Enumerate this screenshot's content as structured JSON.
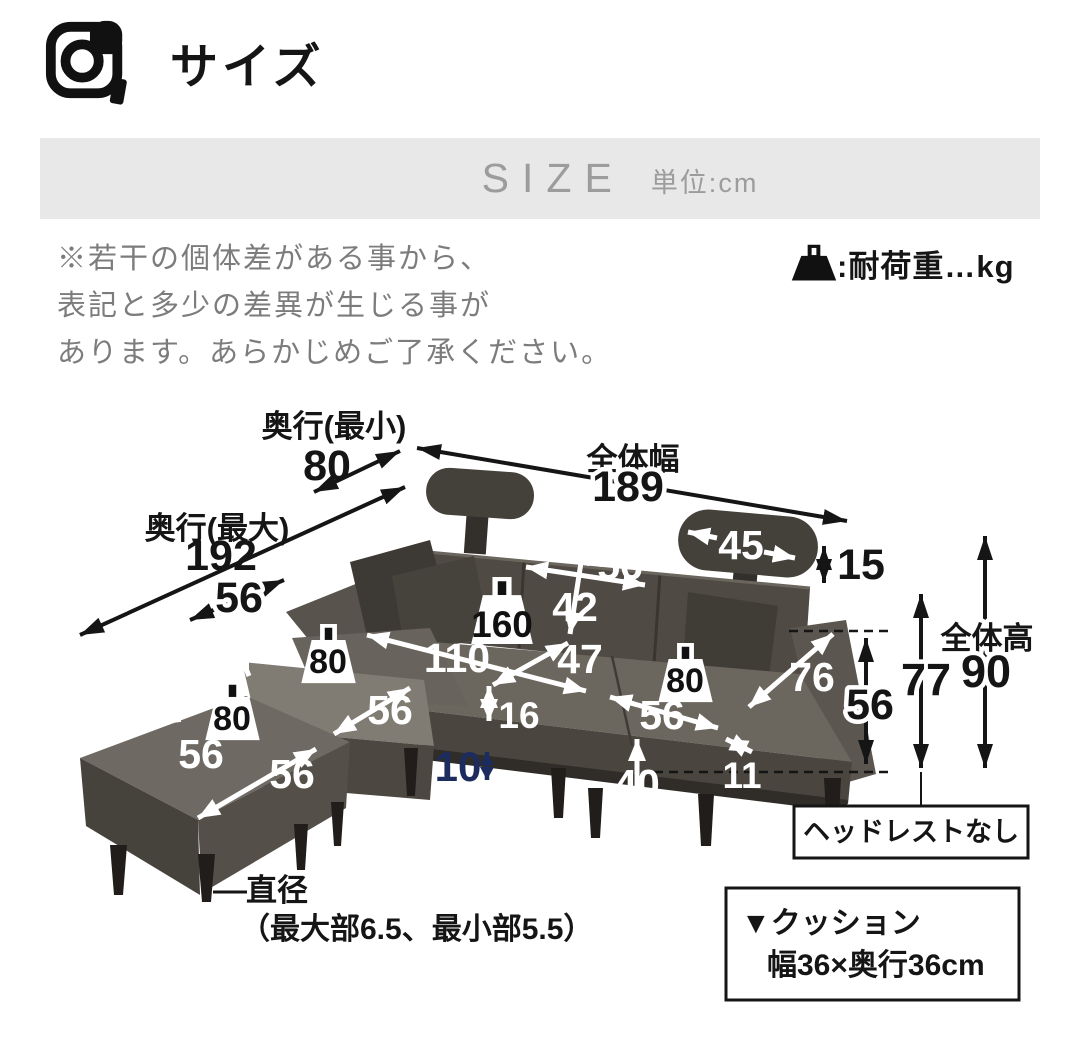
{
  "header": {
    "title": "サイズ"
  },
  "banner": {
    "size": "SIZE",
    "unit": "単位:cm"
  },
  "disclaimer": {
    "line1": "※若干の個体差がある事から、",
    "line2": "表記と多少の差異が生じる事が",
    "line3": "あります。あらかじめご了承ください。"
  },
  "legend": {
    "load": ":耐荷重…kg"
  },
  "colors": {
    "navy": "#1d2c5e",
    "black": "#151515",
    "banner_gray": "#e8e8e8"
  },
  "diagram": {
    "depth_min_label": "奥行(最小)",
    "depth_min": "80",
    "overall_width_label": "全体幅",
    "overall_width": "189",
    "depth_max_label": "奥行(最大)",
    "depth_max": "192",
    "corner_width": "56",
    "back_cushion_height": "18",
    "headrest_width": "45",
    "headrest_height": "15",
    "backrest_width": "56",
    "backrest_height": "42",
    "seat_total_width": "110",
    "seat_depth": "47",
    "seat_thickness": "16",
    "right_seat_width": "56",
    "seat_height": "40",
    "armrest_thickness": "11",
    "armrest_length": "76",
    "armrest_height": "56",
    "no_headrest_height": "77",
    "overall_height_label": "全体高",
    "overall_height": "90",
    "leg_height": "10",
    "ottoman_back_width": "56",
    "ottoman_front_depth": "56",
    "ottoman2_width": "56",
    "load_corner": "80",
    "load_ottoman": "80",
    "load_center": "160",
    "load_right": "80",
    "leg_note_line1": "直径",
    "leg_note_line2": "（最大部6.5、最小部5.5）",
    "headrest_note": "ヘッドレストなし",
    "cushion_note_line1": "▼クッション",
    "cushion_note_line2": "幅36×奥行36cm"
  }
}
